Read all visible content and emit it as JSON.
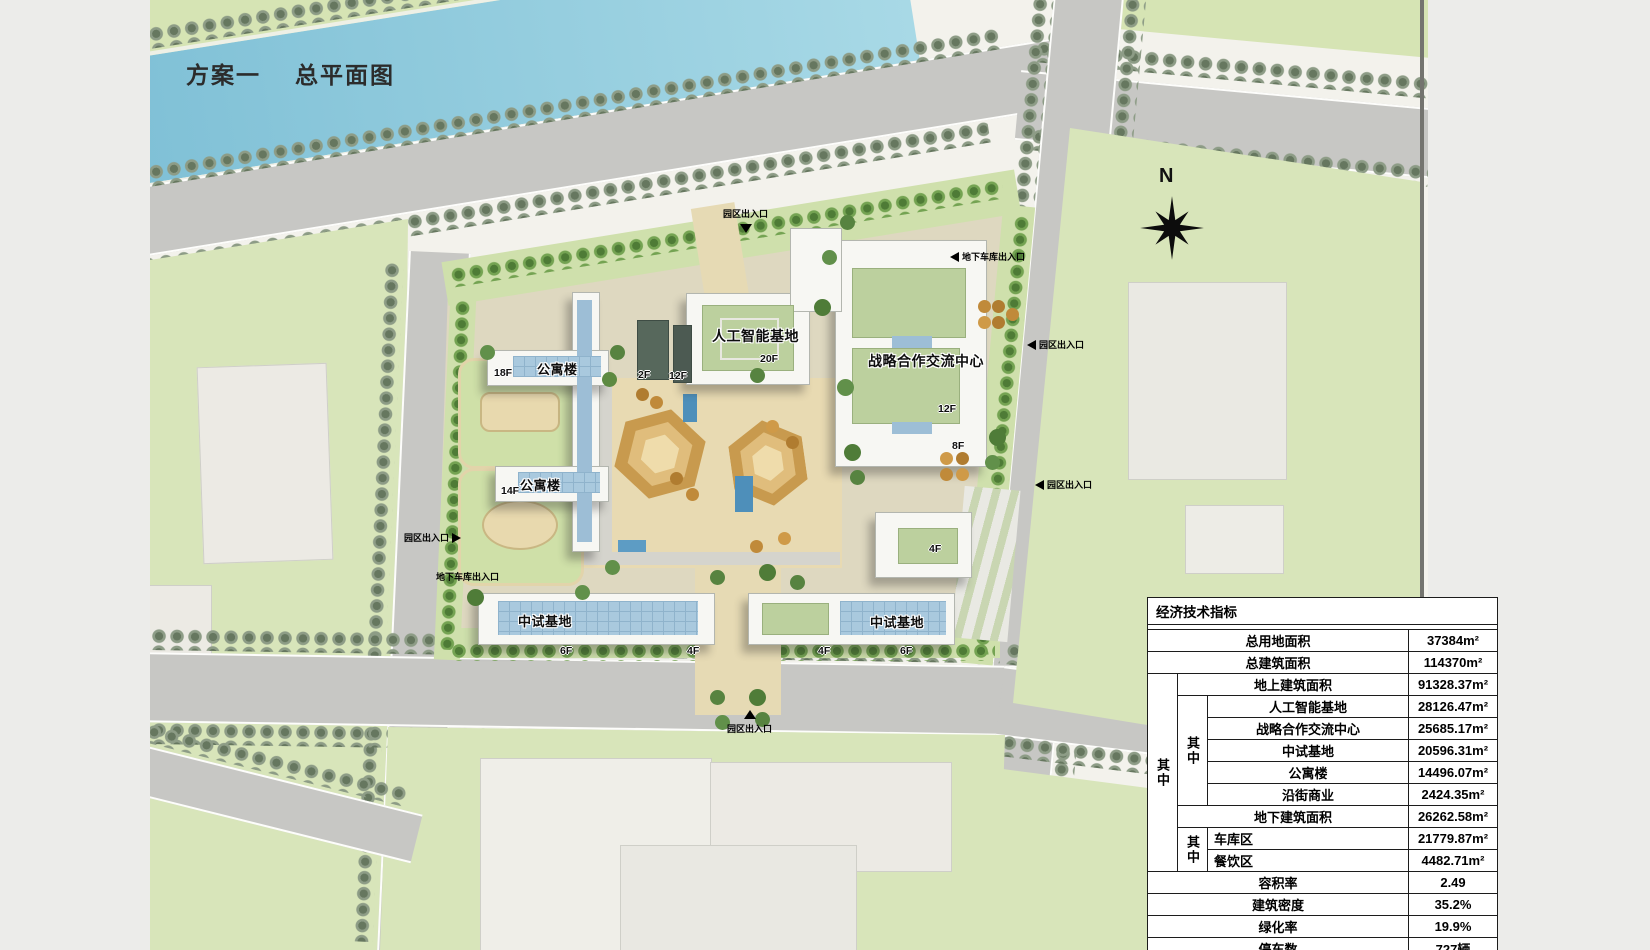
{
  "title": {
    "part1": "方案一",
    "part2": "总平面图"
  },
  "compass": {
    "north": "N"
  },
  "map": {
    "buildings": {
      "apt1": {
        "label": "公寓楼",
        "floor": "18F"
      },
      "apt2": {
        "label": "公寓楼",
        "floor": "14F"
      },
      "ai": {
        "label": "人工智能基地",
        "floor": "20F"
      },
      "podium_2f": {
        "floor": "2F"
      },
      "podium_12f": {
        "floor": "12F"
      },
      "strategic": {
        "label": "战略合作交流中心",
        "floor": "12F"
      },
      "strategic_8f": {
        "floor": "8F"
      },
      "pilot_left": {
        "label": "中试基地",
        "floor_a": "6F",
        "floor_b": "4F"
      },
      "pilot_right": {
        "label": "中试基地",
        "floor_a": "4F",
        "floor_b": "6F"
      },
      "small_4f": {
        "floor": "4F"
      }
    },
    "entrances": {
      "top": "园区出入口",
      "garage_right": "地下车库出入口",
      "right_upper": "园区出入口",
      "right_lower": "园区出入口",
      "left": "园区出入口",
      "garage_left": "地下车库出入口",
      "bottom": "园区出入口"
    }
  },
  "table": {
    "title": "经济技术指标",
    "col_qizhong": "其中",
    "rows": {
      "total_land": {
        "label": "总用地面积",
        "value": "37384m²"
      },
      "total_build": {
        "label": "总建筑面积",
        "value": "114370m²"
      },
      "above": {
        "label": "地上建筑面积",
        "value": "91328.37m²"
      },
      "ai": {
        "label": "人工智能基地",
        "value": "28126.47m²"
      },
      "strategic": {
        "label": "战略合作交流中心",
        "value": "25685.17m²"
      },
      "pilot": {
        "label": "中试基地",
        "value": "20596.31m²"
      },
      "apartment": {
        "label": "公寓楼",
        "value": "14496.07m²"
      },
      "street_retail": {
        "label": "沿街商业",
        "value": "2424.35m²"
      },
      "below": {
        "label": "地下建筑面积",
        "value": "26262.58m²"
      },
      "garage": {
        "label": "车库区",
        "value": "21779.87m²"
      },
      "dining": {
        "label": "餐饮区",
        "value": "4482.71m²"
      },
      "far": {
        "label": "容积率",
        "value": "2.49"
      },
      "density": {
        "label": "建筑密度",
        "value": "35.2%"
      },
      "green_rate": {
        "label": "绿化率",
        "value": "19.9%"
      },
      "parking": {
        "label": "停车数",
        "value": "727辆"
      }
    }
  },
  "colors": {
    "river": "#8cc6da",
    "road": "#c7c7c4",
    "green_block": "#d6e3b4",
    "roof_green": "#bcd09e",
    "glass_blue": "#a9c9de",
    "plaza_tan": "#e8dab2"
  }
}
